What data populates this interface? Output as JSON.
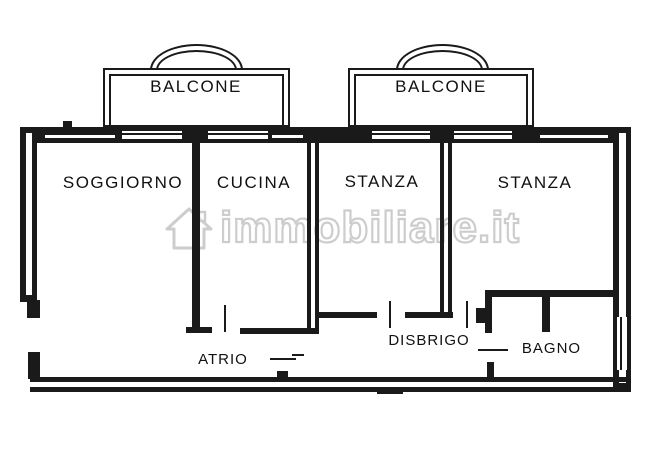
{
  "plan": {
    "rooms": [
      {
        "id": "balcone-left",
        "label": "BALCONE"
      },
      {
        "id": "balcone-right",
        "label": "BALCONE"
      },
      {
        "id": "soggiorno",
        "label": "SOGGIORNO"
      },
      {
        "id": "cucina",
        "label": "CUCINA"
      },
      {
        "id": "stanza-left",
        "label": "STANZA"
      },
      {
        "id": "stanza-right",
        "label": "STANZA"
      },
      {
        "id": "atrio",
        "label": "ATRIO"
      },
      {
        "id": "disbrigo",
        "label": "DISBRIGO"
      },
      {
        "id": "bagno",
        "label": "BAGNO"
      }
    ]
  },
  "watermark": {
    "text": "immobiliare.it",
    "icon": "house-icon"
  },
  "colors": {
    "line": "#1a1a1a",
    "background": "#ffffff",
    "watermark_stroke": "#c8c8c8"
  }
}
